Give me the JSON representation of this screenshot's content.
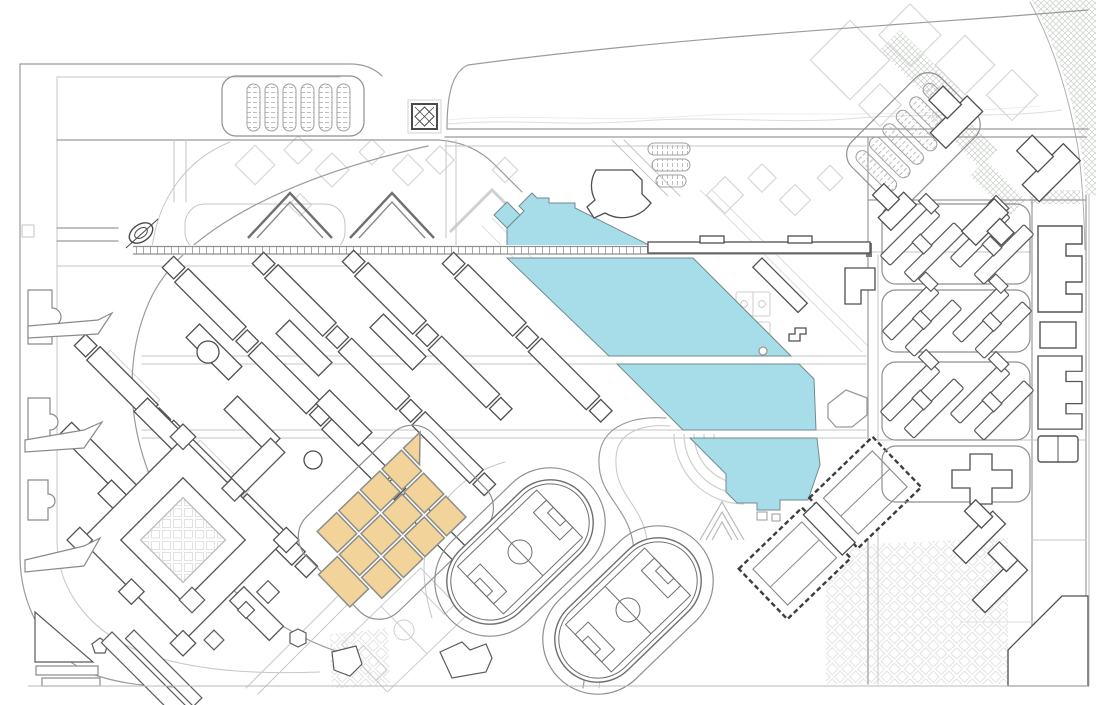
{
  "document": {
    "kind": "architectural site plan",
    "has_text_labels": false
  },
  "colors": {
    "background": "#ffffff",
    "water": "#a6dde9",
    "water_edge": "#73898f",
    "highlight": "#f2d49b",
    "highlight_edge": "#8d8d88",
    "building_dark": "#4f4f4f",
    "building_mid": "#8a8a8a",
    "road": "#9b9b9b",
    "line_light": "#c6c6c6",
    "line_faint": "#dedede",
    "hatch": "#c9cfc8",
    "boundary": "#b8b8b8"
  },
  "features": {
    "water_canal": {
      "icon": "water-area",
      "segments": 4,
      "has_stepped_ends": true
    },
    "highlight_cluster": {
      "icon": "highlighted-building-grid",
      "cells": 13,
      "rotation_deg": -44
    },
    "academic_lattice": {
      "icon": "diagonal-building-grid",
      "rows": 6
    },
    "running_tracks": {
      "icon": "athletics-track",
      "count": 2,
      "soccer_fields": 2,
      "faint_fields": 1
    },
    "dashed_halls": {
      "icon": "dashed-outline-hall",
      "count": 2
    },
    "dormitory_blocks": {
      "icon": "z-slab-block",
      "count": 3
    },
    "edge_buildings_east": {
      "icon": "e-shaped-building",
      "count": 2,
      "courts": 2
    },
    "parking_topleft": {
      "icon": "parking-rows",
      "rows": 6
    },
    "parking_topright": {
      "icon": "parking-rows",
      "rows": 6
    },
    "parking_mid": {
      "icon": "parking-rows",
      "rows": 3
    },
    "chevron_buildings": {
      "icon": "chevron-building",
      "count": 2,
      "ghost_count": 1
    },
    "quadrangle": {
      "icon": "courtyard-building",
      "count": 1
    },
    "gate_pavilion": {
      "icon": "square-pavilion",
      "count": 1
    },
    "axis_sculpture": {
      "icon": "oval-sculpture",
      "count": 1
    },
    "pedestrian_axis": {
      "icon": "ladder-bridge",
      "x_start": 133,
      "x_end": 870
    },
    "basketball_courts": {
      "icon": "court",
      "count": 2
    },
    "amphitheater": {
      "icon": "stepped-arcs",
      "count": 1
    },
    "hatched_green_edge": {
      "icon": "crosshatch-band",
      "corner": "top-right"
    }
  }
}
